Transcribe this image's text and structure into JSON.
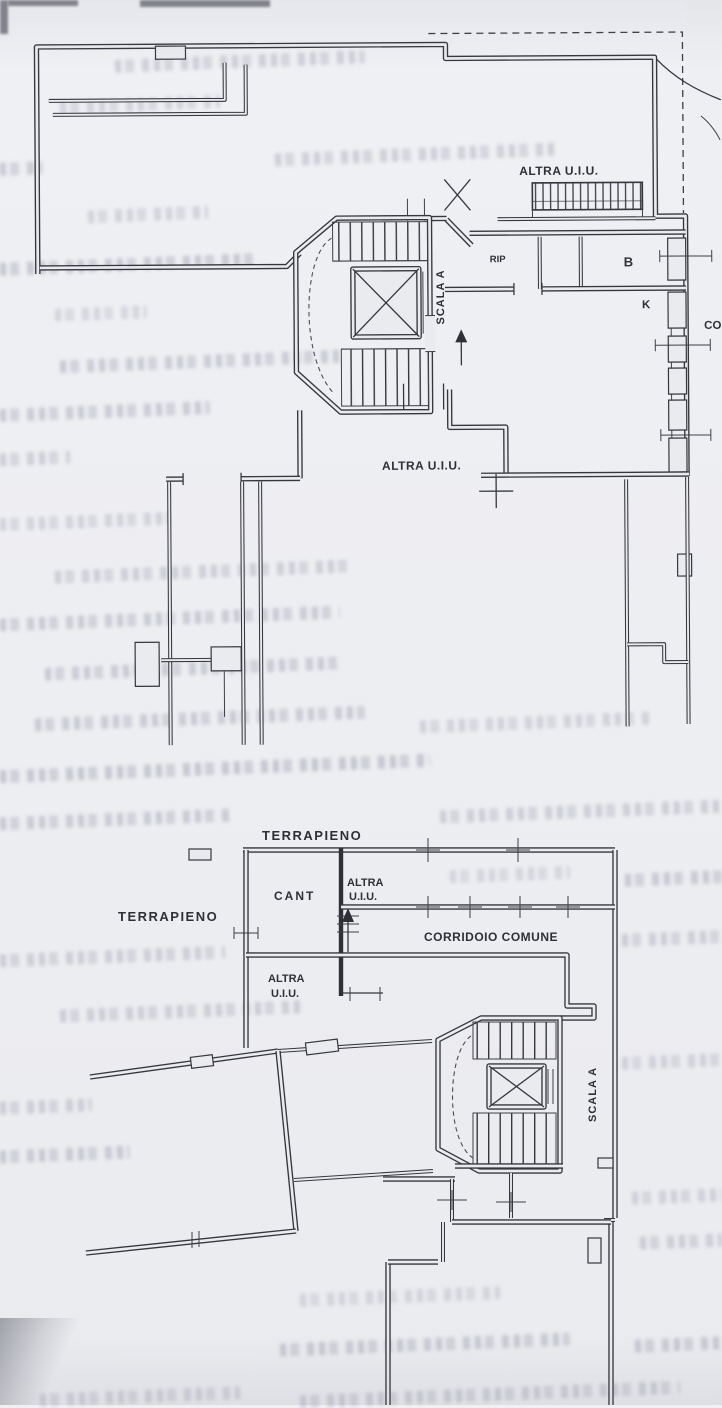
{
  "colors": {
    "paper": "#edeef2",
    "ink": "#34353c",
    "bleed": "#9a9dad"
  },
  "plans": {
    "upper": {
      "labels": {
        "altra_uiu_top": "ALTRA U.I.U.",
        "room_rip": "RIP",
        "room_b": "B",
        "room_k": "K",
        "scala_a": "SCALA A",
        "altra_uiu_mid": "ALTRA U.I.U.",
        "edge_clipped": "CO"
      }
    },
    "lower": {
      "labels": {
        "terrapieno_top": "TERRAPIENO",
        "terrapieno_left": "TERRAPIENO",
        "cant": "CANT",
        "altra_upper_line1": "ALTRA",
        "altra_upper_line2": "U.I.U.",
        "corridoio_comune": "CORRIDOIO COMUNE",
        "altra_lower_line1": "ALTRA",
        "altra_lower_line2": "U.I.U.",
        "scala_a": "SCALA A"
      }
    }
  }
}
